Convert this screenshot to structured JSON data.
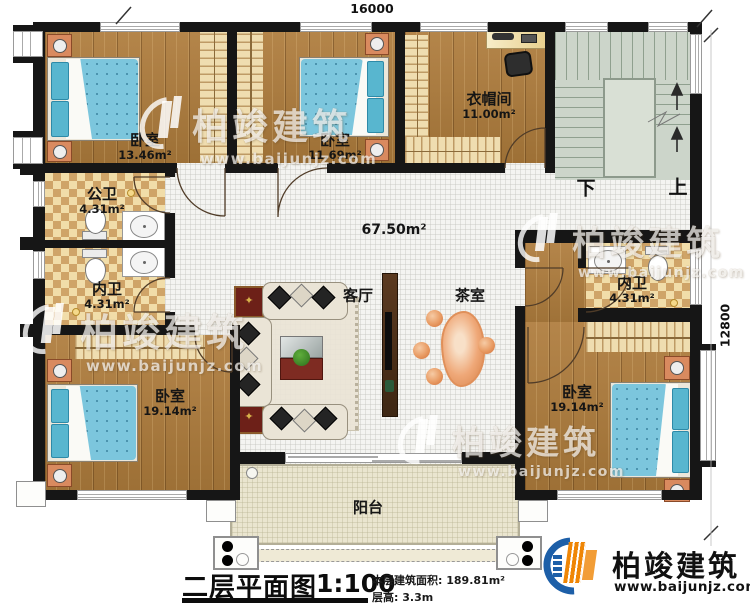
{
  "dimensions": {
    "width_mm": "16000",
    "depth_mm": "12800"
  },
  "rooms": {
    "bedroom_tl": {
      "name": "卧室",
      "area": "13.46m²"
    },
    "bedroom_tm": {
      "name": "卧室",
      "area": "11.69m²"
    },
    "cloakroom": {
      "name": "衣帽间",
      "area": "11.00m²"
    },
    "bath_public": {
      "name": "公卫",
      "area": "4.31m²"
    },
    "bath_ensuite_left": {
      "name": "内卫",
      "area": "4.31m²"
    },
    "bath_ensuite_right": {
      "name": "内卫",
      "area": "4.31m²"
    },
    "bedroom_bl": {
      "name": "卧室",
      "area": "19.14m²"
    },
    "bedroom_br": {
      "name": "卧室",
      "area": "19.14m²"
    },
    "living_room": {
      "name": "客厅"
    },
    "tea_room": {
      "name": "茶室"
    },
    "hall": {
      "area": "67.50m²"
    },
    "balcony": {
      "name": "阳台"
    }
  },
  "stairs": {
    "down_label": "下",
    "up_label": "上"
  },
  "title_block": {
    "title": "二层平面图",
    "scale": "1:100",
    "area_label": "本层建筑面积:",
    "area_value": "189.81m²",
    "height_label": "层高:",
    "height_value": "3.3m"
  },
  "brand": {
    "name": "柏竣建筑",
    "website": "www.baijunjz.com"
  }
}
